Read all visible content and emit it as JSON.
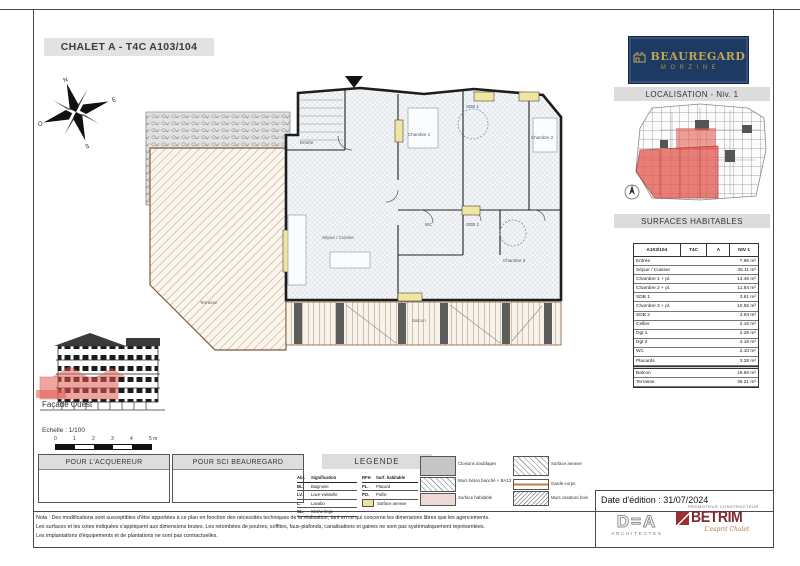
{
  "colors": {
    "brand_navy": "#1d3a63",
    "brand_gold": "#c2a452",
    "highlight_red": "#e25b52"
  },
  "sheet": {
    "title": "CHALET A - T4C A103/104",
    "edition_date": "Date d'édition : 31/07/2024"
  },
  "brand": {
    "name": "BEAUREGARD",
    "subtitle": "MORZINE"
  },
  "localisation": {
    "title": "LOCALISATION - Niv. 1"
  },
  "surfaces": {
    "title": "SURFACES HABITABLES",
    "header": [
      "A103/104",
      "T4C",
      "A",
      "NIV 1"
    ],
    "rows": [
      [
        "Entrée",
        "7.96 m²"
      ],
      [
        "Séjour / Cuisine",
        "35.11 m²"
      ],
      [
        "Chambre 1 + pl.",
        "13.46 m²"
      ],
      [
        "Chambre 2 + pl.",
        "11.84 m²"
      ],
      [
        "SDB 1",
        "3.81 m²"
      ],
      [
        "Chambre 3 + pl.",
        "10.55 m²"
      ],
      [
        "SDB 2",
        "3.94 m²"
      ],
      [
        "Cellier",
        "2.16 m²"
      ],
      [
        "Dgt 1",
        "2.28 m²"
      ],
      [
        "Dgt 2",
        "4.18 m²"
      ],
      [
        "WC",
        "2.10 m²"
      ],
      [
        "Placards",
        "3.28 m²"
      ]
    ],
    "total": [
      "Total",
      "100.16 m²"
    ],
    "annex": [
      [
        "Balcon",
        "19.56 m²"
      ],
      [
        "Terrasse",
        "36.21 m²"
      ]
    ]
  },
  "plan": {
    "labels": {
      "entree": "Entrée",
      "ch1": "Chambre 1",
      "sdb1": "SDB 1",
      "ch2": "Chambre 2",
      "sejour": "Séjour / Cuisine",
      "ch3": "Chambre 3",
      "wc": "WC",
      "sdb2": "SDB 2",
      "balcon": "Balcon",
      "terrasse": "Terrasse"
    }
  },
  "compass": {
    "n": "N",
    "s": "S",
    "e": "E",
    "o": "O"
  },
  "facade": {
    "label": "Façade Ouest",
    "scale_label": "Echelle : 1/100",
    "scale_ticks": [
      "0",
      "1",
      "2",
      "3",
      "4",
      "5 m"
    ]
  },
  "stamps": {
    "acquirer": "POUR L'ACQUEREUR",
    "sci": "POUR SCI BEAUREGARD"
  },
  "legend": {
    "title": "LEGENDE",
    "abbr_a_header": [
      "Abr.",
      "Signification"
    ],
    "abbr_a": [
      [
        "BL.",
        "Baignoire"
      ],
      [
        "LV.",
        "Lave-vaisselle"
      ],
      [
        "L.",
        "Lavabo"
      ],
      [
        "SL.",
        "Sèche-linge"
      ]
    ],
    "abbr_b_header": [
      "RFH",
      "Surf. habitable"
    ],
    "abbr_b": [
      [
        "PL.",
        "Placard"
      ],
      [
        "PO.",
        "Poêle"
      ]
    ],
    "annex_swatch": "Surface annexe",
    "left_swatches": [
      "Cloisons doublages",
      "Murs béton banché + BA13",
      "Surface habitable"
    ],
    "right_swatches": [
      "Surface annexe",
      "Garde-corps",
      "Murs ossature bois"
    ]
  },
  "notes": [
    "Nota : Des modifications sont susceptibles d'être apportées à ce plan en fonction des nécessités techniques de la réalisation, tant en ce qui concerne les dimensions libres que les agencements.",
    "Les surfaces et les cotes indiquées s'appliquent aux dimensions brutes. Les retombées de poutres, soffites, faux-plafonds, canalisations et gaines ne sont pas systématiquement représentées.",
    "Les implantations d'équipements et de plantations ne sont pas contractuelles."
  ],
  "logos": {
    "dea": "D=A",
    "dea_sub": "ARCHITECTES",
    "betrim": "BETRIM",
    "betrim_top": "PROMOTEUR CONSTRUCTEUR",
    "betrim_script": "L'esprit Chalet"
  }
}
